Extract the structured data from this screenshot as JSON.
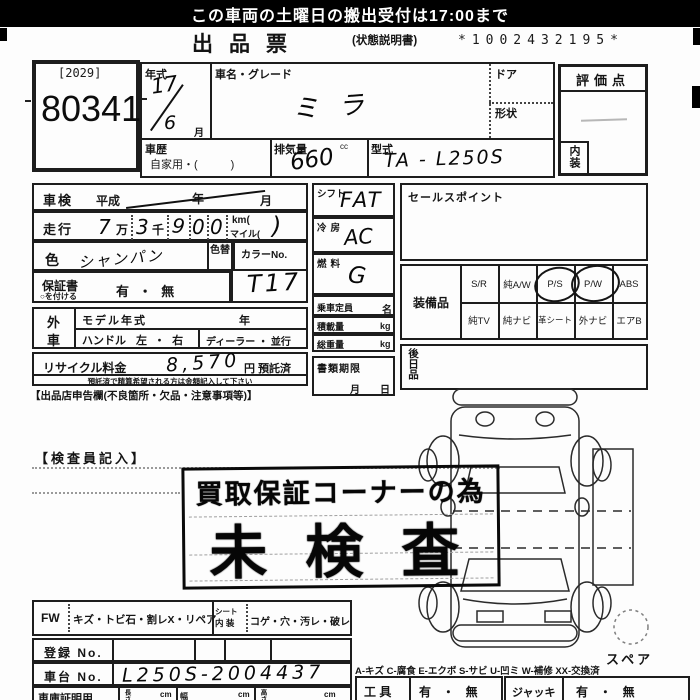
{
  "colors": {
    "ink": "#1a1a1a",
    "paper": "#fdfdfd",
    "banner_bg": "#000000",
    "banner_text": "#ffffff"
  },
  "banner": {
    "text": "この車両の土曜日の搬出受付は17:00まで"
  },
  "title": {
    "main": "出品票",
    "sub": "(状態説明書)",
    "serial": "*1002432195*"
  },
  "lot": {
    "code": "[2029]",
    "number": "80341"
  },
  "top": {
    "year_label": "年式",
    "year_top": "17",
    "year_bottom": "6",
    "year_month": "月",
    "name_label": "車名・グレード",
    "name_value": "ミラ",
    "door_label": "ドア",
    "shape_label": "形状",
    "history_label": "車歴",
    "history_value": "自家用・(　　　)",
    "disp_label": "排気量",
    "disp_value": "660",
    "disp_unit": "cc",
    "model_label": "型式",
    "model_value": "TA - L250S"
  },
  "rating": {
    "label": "評価点",
    "interior": "内装"
  },
  "left": {
    "shaken_label": "車検",
    "shaken_era": "平成",
    "shaken_year": "年",
    "shaken_month": "月",
    "run_label": "走行",
    "run_man": "7",
    "run_man_unit": "万",
    "run_sen": "3",
    "run_sen_unit": "千",
    "run_d1": "9",
    "run_d2": "0",
    "run_d3": "0",
    "run_km": "km(",
    "run_mile": "マイル(",
    "run_close": ")",
    "color_label": "色",
    "color_value": "シャンパン",
    "color_change": "色替",
    "colorno_label": "カラーNo.",
    "colorno_value": "T17",
    "warranty_label": "保証書",
    "warranty_note": "○を付ける",
    "warranty_opts": "有 ・ 無",
    "gai": "外",
    "sha": "車",
    "modelyear_label": "モデル年式",
    "modelyear_unit": "年",
    "handle_label": "ハンドル",
    "handle_opts": "左 ・ 右",
    "dealer_opts": "ディーラー ・ 並行",
    "recycle_label": "リサイクル料金",
    "recycle_value": "8,570",
    "recycle_unit": "円 預託済",
    "recycle_note": "預託済で精算希望される方は金額記入して下さい",
    "declaration": "【出品店申告欄(不良箇所・欠品・注意事項等)】"
  },
  "mid": {
    "shift_label": "シフト",
    "shift_value": "FAT",
    "ac_label": "冷房",
    "ac_value": "AC",
    "fuel_label": "燃料",
    "fuel_value": "G",
    "cap_label": "乗車定員",
    "cap_unit": "名",
    "load_label": "積載量",
    "load_unit": "kg",
    "weight_label": "総重量",
    "weight_unit": "kg",
    "docs_label": "書類期限",
    "docs_month": "月",
    "docs_day": "日"
  },
  "right": {
    "sales_label": "セールスポイント",
    "equip_label": "装備品",
    "equip_row1": [
      "S/R",
      "純A/W",
      "P/S",
      "P/W",
      "ABS"
    ],
    "equip_row2": [
      "純TV",
      "純ナビ",
      "革シート",
      "外ナビ",
      "エアB"
    ],
    "equip_circled": [
      "P/S",
      "P/W"
    ],
    "later_label": "後日品"
  },
  "bottom": {
    "inspector": "【検査員記入】",
    "stamp_line1": "買取保証コーナーの為",
    "stamp_line2": "未検査",
    "spare": "スペア",
    "fw_label": "FW",
    "fw_opts": "キズ・トビ石・割レX・リペア",
    "seat_label1": "シート",
    "seat_label2": "内 装",
    "seat_opts": "コゲ・穴・汚レ・破レ",
    "reg_label": "登録 No.",
    "chassis_label": "車台 No.",
    "chassis_value": "L250S-2004437",
    "legend": "A-キズ C-腐食 E-エクボ S-サビ U-凹ミ W-補修 XX-交換済",
    "garage_label": "車庫証明用",
    "garage_len": "長さ",
    "garage_w": "幅",
    "garage_h": "高さ",
    "cm1": "cm",
    "cm2": "cm",
    "cm3": "cm",
    "tools_label": "工 具",
    "tools_opts": "有 ・ 無",
    "jack_label": "ジャッキ",
    "jack_opts": "有 ・ 無"
  }
}
